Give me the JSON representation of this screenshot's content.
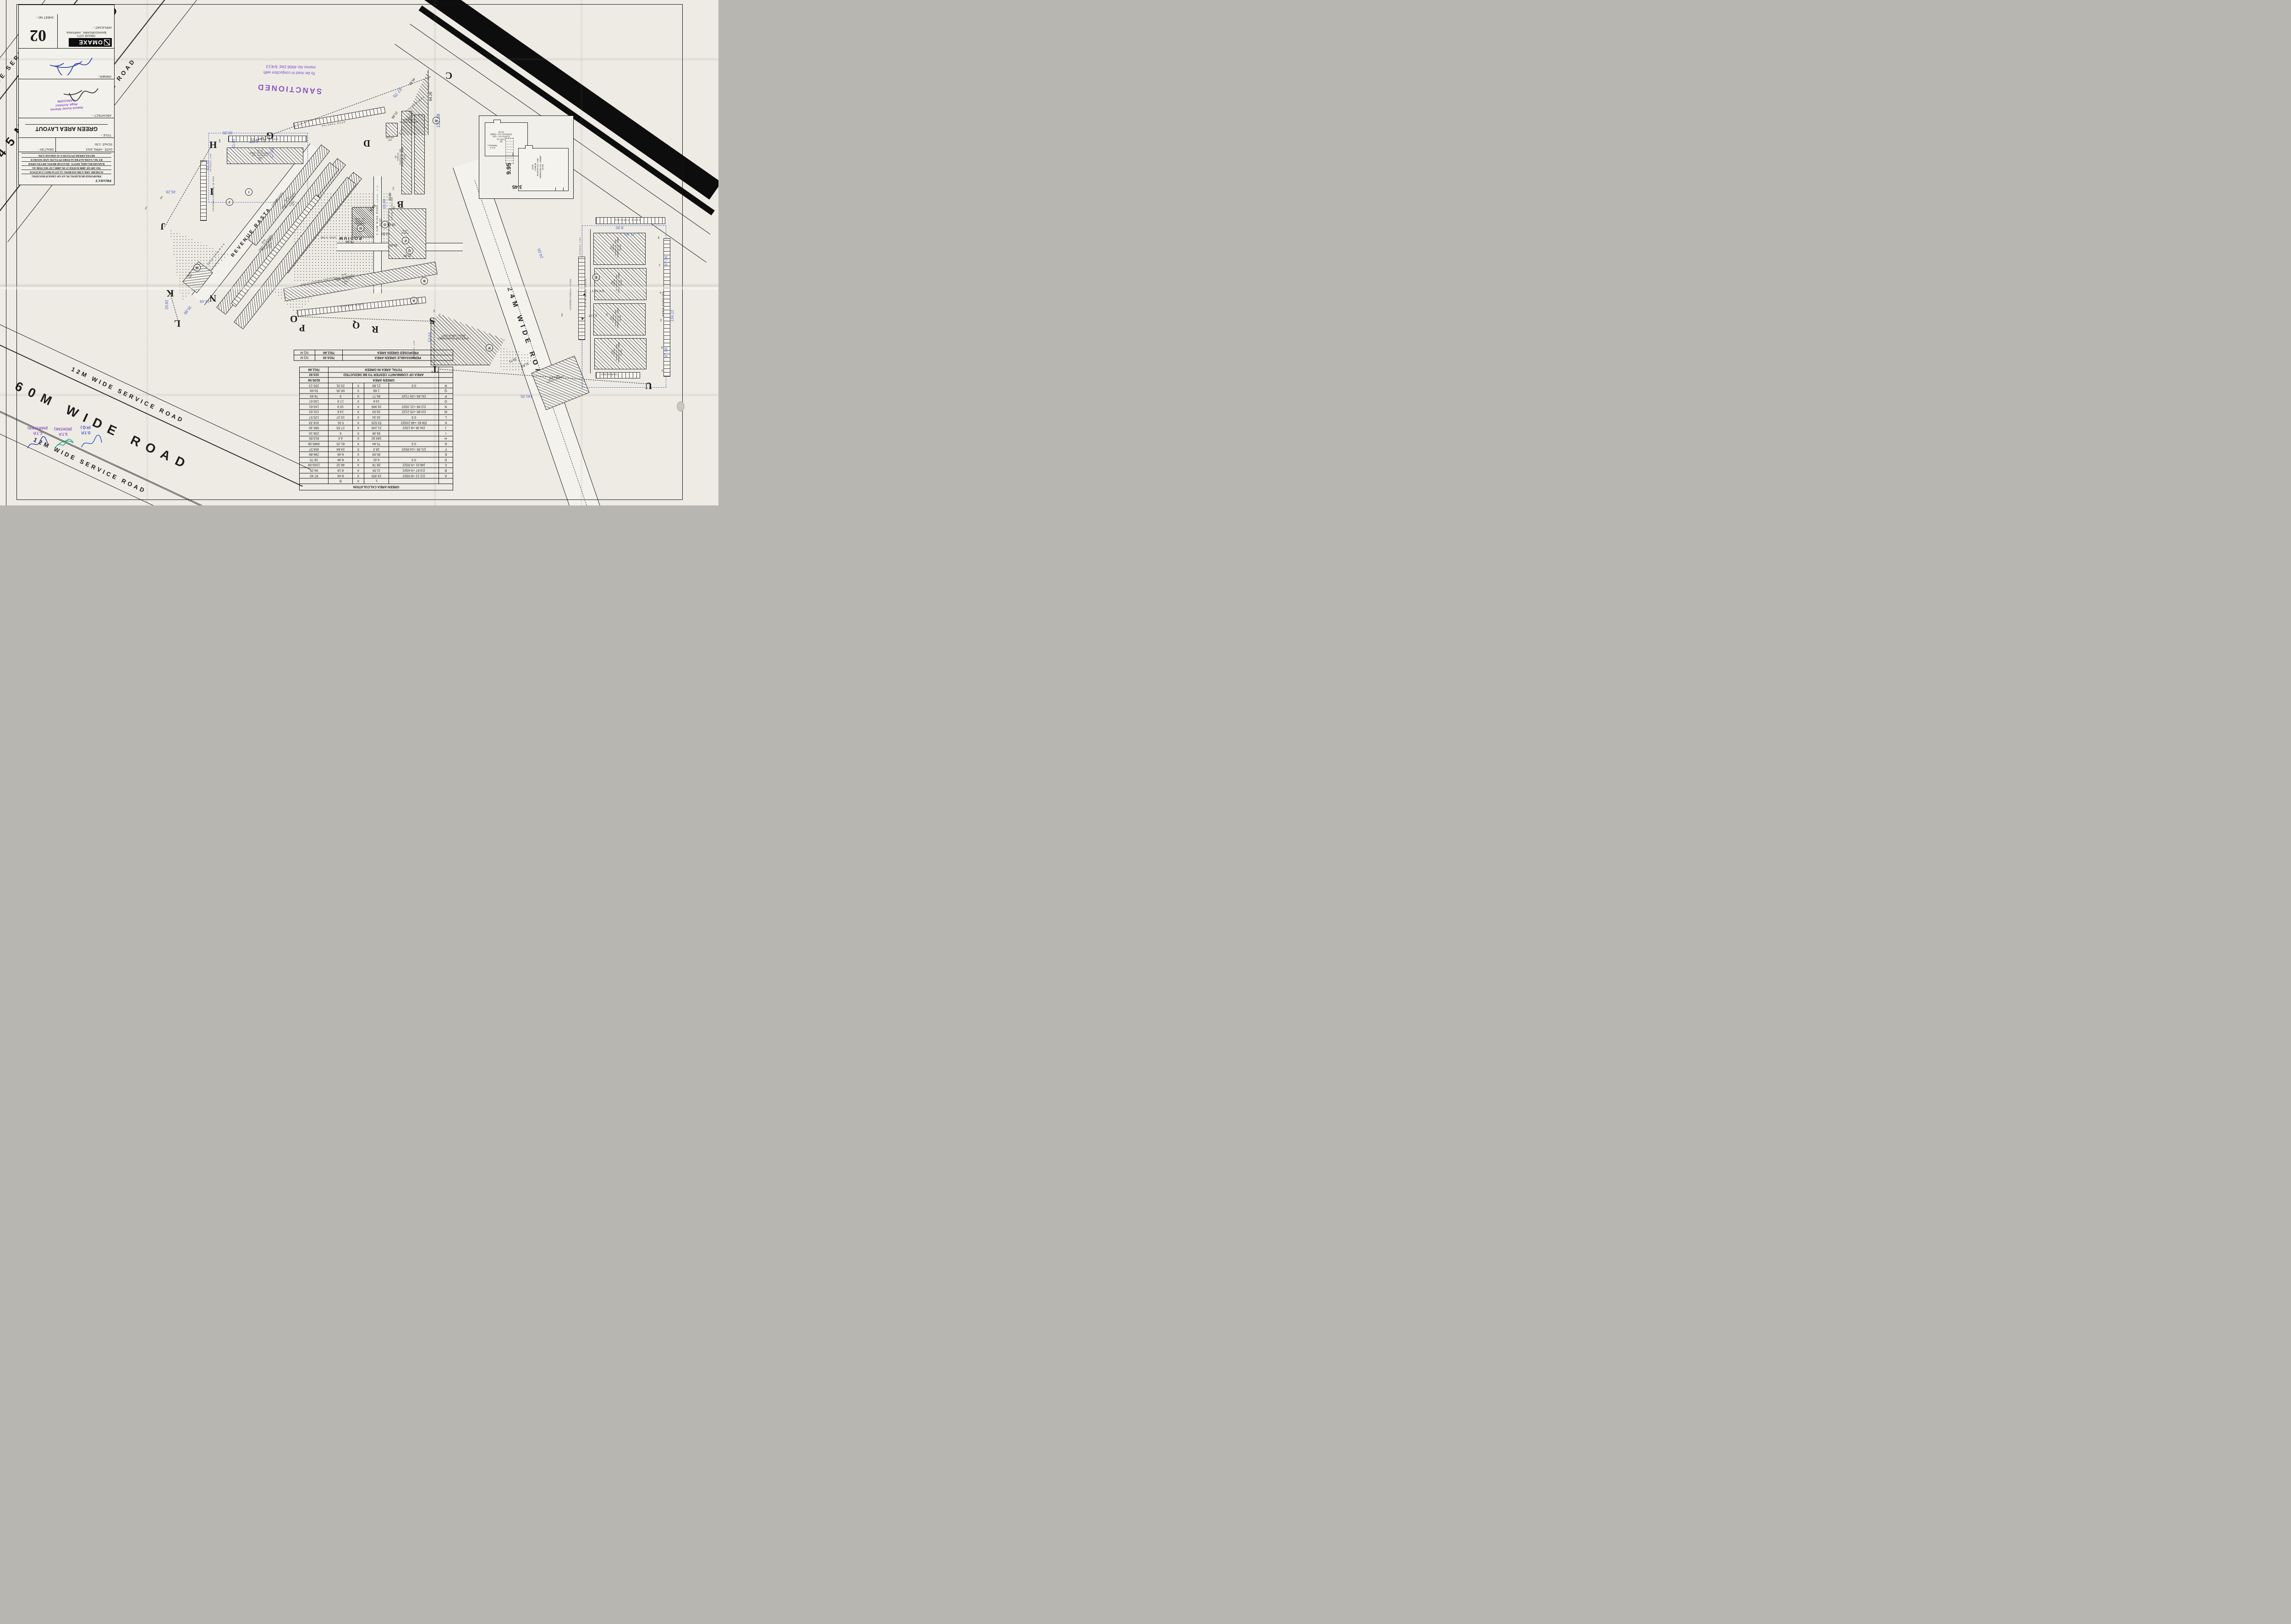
{
  "title_block": {
    "project_label": "PROJECT",
    "project_lines": [
      "PROPOSED BUILDING PLAN OF GROUP HOUSING",
      "SCHEME AREA MEASURING 12.537ACRES ( LICENCE",
      "NO-109 OF 2008 DATED 27-05-2008 ) AT SECTOR-4A",
      "BAHADURGARH, DISTT- JHAJJAR BEING DEVELOPED",
      "BY M/s SANKALP REALTORS PVT.LTD AND SOURCE",
      "DEVELOPERS PVT.LTD C/O OMAXE LTD."
    ],
    "date_label": "DATE",
    "date_value": "-  APRIL 2013",
    "dealt_label": "DEALT BY -",
    "scale_label": "SCALE",
    "scale_value": "-1:50",
    "title_label": "TITLE :-",
    "title_value": "GREEN AREA LAYOUT",
    "architect_label": "ARCHITECT :-",
    "architect_stamp_l1": "Rakesh Kumar Sharma",
    "architect_stamp_l2": "Regd. Architect",
    "architect_stamp_l3": "CA/91/13596",
    "owner_label": "OWNER:-",
    "applicant_label": "APPLICANT  :-",
    "brand": "OMAXE",
    "brand_sub1": "OMAXE CITY,",
    "brand_sub2": "BAHADURGARH , HARYANA.",
    "sheet_label": "SHEET NO :-",
    "sheet_number": "02"
  },
  "stamps": {
    "sanctioned": "SANCTIONED",
    "memo_l1": "To be read in conjuction with",
    "memo_l2": "memo No 4906  Dtd: 6/4/13",
    "dtp_l1": "D.T.P.",
    "dtp_l2": "(H.Q.)",
    "stp_l1": "S.T.P.",
    "stp_l2": "(ROHTAK)",
    "ctp_l1": "C.T.P.",
    "ctp_l2": "(HARYANA)"
  },
  "roads": {
    "r12_top": "12M WIDE SERVICE ROAD",
    "r45": "45M WIDE ROAD",
    "r12_mid": "12M WIDE SERVICE ROAD",
    "r12_low": "12M WIDE SERVICE ROAD",
    "r60": "60M WIDE ROAD",
    "r12_bottom": "12M WIDE SERVICE ROAD",
    "r24": "24M WIDE ROAD",
    "r24_level": "(-900MM LEVEL)",
    "revenue": "REVENUE RASTA",
    "revenue_level": "(-1500MM LEVEL)",
    "r6_v": "6.00M WIDE ROAD",
    "r6_v_level": "(LEVEL -0.0)",
    "r6_h": "6.00M WIDE ROAD",
    "r6_wing": "6.00M WIDE ROAD",
    "r6_cluster": "6.0 M WIDE ROAD",
    "r8": "8.0 M WIDE ROAD",
    "pathway": "6.0 M WIDE PATHWAY"
  },
  "plan": {
    "letters": {
      "b": "B",
      "c": "C",
      "d": "D",
      "g": "G",
      "h": "H",
      "i": "I",
      "j": "J",
      "k": "K",
      "l": "L",
      "n": "N",
      "o": "O",
      "p": "P",
      "q": "Q",
      "r": "R",
      "s": "S",
      "t": "T",
      "u": "U"
    },
    "markers": {
      "a": "A",
      "b": "B",
      "e": "E",
      "f": "F",
      "g": "G",
      "i": "I",
      "j": "J",
      "m": "M",
      "o": "O",
      "p": "P",
      "q": "Q",
      "r": "R"
    },
    "labels": {
      "community": [
        "COMMUNITY",
        "CENTER",
        "LVL +9.050"
      ],
      "podium": "PODIUM",
      "podium_lvl": "(LEVEL +5.75M)",
      "nursery1": [
        "NURSERY SCHOOL",
        "1050.00 SQM"
      ],
      "nursery2": [
        "NURSERY SCHOOL",
        "890.00 SQM"
      ],
      "transformer": [
        "SPACE FOR TRANSFORMER",
        "AREA = 1840.00 SQ.FT"
      ],
      "stp": [
        "STP",
        "136 SQM"
      ],
      "ews": [
        "EWS",
        "(S+8)"
      ],
      "type_a": [
        "(1)",
        "TYPE-A",
        "PLINTH LVL +150",
        "TERRACE LVL +33800",
        "(S+10)"
      ],
      "type_a1": [
        "(2)",
        "TYPE-A1",
        "PLINTH LVL +150",
        "TERRACE LVL +29900",
        "(S+8)"
      ],
      "type_a2": [
        "(5)",
        "TYPE-A2",
        "PLINTH LVL +150",
        "TERRACE LVL +30850",
        "(S+9)"
      ],
      "type_b3": [
        "(3)",
        "TYPE-B",
        "PLINTH LVL +150",
        "TERRACE LVL +30850",
        "(S+9)"
      ],
      "type_b4": [
        "(4)",
        "TYPE-B",
        "PLINTH LVL +150",
        "TERRACE LVL +30850",
        "(S+9)"
      ],
      "type_b_e": [
        "TYPE-B",
        "(S+9)"
      ],
      "type_b1_21": [
        "(21)",
        "TYPE-B1",
        "PLINTH LVL +150",
        "TERRACE LVL +33800",
        "(S+10)"
      ],
      "type_b1_20": [
        "(20)",
        "TYPE-B1",
        "PLINTH LVL +150",
        "TERRACE LVL +33800",
        "(S+10)"
      ],
      "type_b1_19": [
        "(19)",
        "TYPE-B1",
        "PLINTH LVL +150",
        "TERRACE LVL +33800",
        "(S+10)"
      ],
      "type_b1_18": [
        "(18)",
        "TYPE-B1",
        "PLINTH LVL +150",
        "TERRACE LVL +33800",
        "(S+10)"
      ]
    },
    "inset": {
      "a2": [
        "(5)",
        "TYPE-A2",
        "PLINTH LVL +150",
        "TERRACE LVL +30850",
        "(S+9)"
      ],
      "b": [
        "(12a)",
        "TYPE-B",
        "PLINTH LVL +150",
        "TERRACE LVL +30850",
        "(S+9)"
      ],
      "pergola": [
        "R.C.C",
        "PERGOLA"
      ],
      "d1": "9.95",
      "d2": "3.45"
    },
    "parking": {
      "open": "OPEN PARKING",
      "covered17": "COVERED PARKING-17NOS",
      "covered12": "COVERED PARKING-12 NOS",
      "covered10": "COVERED PARKING-10 NOS",
      "cpark6": "C.PARKING-6NOS",
      "entry": "ENTRY",
      "exit": "EXIT",
      "setback": "SETBACK LINE"
    },
    "dims": {
      "d1": "64.26",
      "d2": "122.38",
      "d3": "87.75",
      "d4": "46.85",
      "d5": "60.35",
      "d6": "63.70",
      "d7": "57.00",
      "d8": "45.26",
      "d9": "8.00",
      "d10": "11.00",
      "d11": "13.42",
      "d12": "134.12",
      "d13": "67.06",
      "d14": "67.06",
      "d15": "181.05",
      "d16": "53.64",
      "d17": "24.00",
      "d18": "35.88",
      "d19": "26.82",
      "d20": "12.48",
      "d21": "33.90",
      "d22": "81.25",
      "d23": "75.94",
      "d24": "35.09",
      "d25": "14.60",
      "d26": "18.20",
      "d27": "25.81",
      "d28": "21.57",
      "d29": "21.89",
      "d30": "23.31",
      "d31": "29.71",
      "d32": "31.83",
      "d35": "10.00",
      "d36": "8.00",
      "d37": "11.00"
    },
    "plots": {
      "p37": "37",
      "p38": "38",
      "p54": "54",
      "p61": "61",
      "p72": "72",
      "p85": "85",
      "p95": "95",
      "p110": "110",
      "p111": "111",
      "p197": "197",
      "p198": "198",
      "p228": "228",
      "p249": "249",
      "p257": "257",
      "p272": "272",
      "p281": "281"
    }
  },
  "calc_table": {
    "title": "GREEN AREA CALCULATION",
    "header": {
      "l": "L",
      "x": "X",
      "b": "B"
    },
    "rows": [
      {
        "id": "A",
        "f": "(12.12 +8.59)/2",
        "l": "10.355",
        "x": "X",
        "b": "8.44",
        "a": "87.40"
      },
      {
        "id": "B",
        "f": "(13.67 +9.43)/2",
        "l": "11.55",
        "x": "X",
        "b": "8.16",
        "a": "94.25"
      },
      {
        "id": "C",
        "f": "(48.01 +9.55)/2",
        "l": "28.78",
        "x": "X",
        "b": "46.32",
        "a": "1333.09"
      },
      {
        "id": "D",
        "f": "0.5",
        "l": "4.42",
        "x": "X",
        "b": "8.46",
        "a": "18.70"
      },
      {
        "id": "E",
        "f": "",
        "l": "35.09",
        "x": "X",
        "b": "8.46",
        "a": "296.86"
      },
      {
        "id": "F",
        "f": "(21.95 +14.65)/2",
        "l": "18.3",
        "x": "X",
        "b": "24.84",
        "a": "454.57"
      },
      {
        "id": "G",
        "f": "0.5",
        "l": "75.94",
        "x": "X",
        "b": "81.25",
        "a": "3085.06"
      },
      {
        "id": "H",
        "f": "",
        "l": "184.92",
        "x": "X",
        "b": "4.4",
        "a": "813.65"
      },
      {
        "id": "I",
        "f": "",
        "l": "39.36",
        "x": "X",
        "b": "6",
        "a": "236.16"
      },
      {
        "id": "J",
        "f": "(34.36 +8.13)/2",
        "l": "21.245",
        "x": "X",
        "b": "27.55",
        "a": "585.30"
      },
      {
        "id": "K",
        "f": "(58.82 +48.233)/2",
        "l": "53.525",
        "x": "X",
        "b": "5.91",
        "a": "316.33"
      },
      {
        "id": "L",
        "f": "0.5",
        "l": "16.34",
        "x": "X",
        "b": "15.37",
        "a": "125.57"
      },
      {
        "id": "M",
        "f": "(10.85 +25.21)/2",
        "l": "18.03",
        "x": "X",
        "b": "14.6",
        "a": "131.62"
      },
      {
        "id": "N",
        "f": "(12.66 +21.33)/2",
        "l": "16.995",
        "x": "X",
        "b": "16.9",
        "a": "143.61"
      },
      {
        "id": "O",
        "f": "",
        "l": "14.6",
        "x": "X",
        "b": "17.9",
        "a": "130.67"
      },
      {
        "id": "P",
        "f": "(31.83 +29.71)/2",
        "l": "30.77",
        "x": "X",
        "b": "5",
        "a": "76.93"
      },
      {
        "id": "Q",
        "f": "",
        "l": "1.68",
        "x": "X",
        "b": "60.35",
        "a": "50.69"
      },
      {
        "id": "R",
        "f": "0.5",
        "l": "21.89",
        "x": "X",
        "b": "23.31",
        "a": "255.13"
      }
    ],
    "summary": [
      {
        "label": "GREEN AREA",
        "value": "8235.58"
      },
      {
        "label": "AREA OF COMMUNITY CENTER TO BE DEDUCTED",
        "value": "323.92"
      },
      {
        "label": "TOTAL AREA IN GREEN",
        "value": "7911.66"
      }
    ]
  },
  "summary_table": {
    "rows": [
      {
        "label": "PERMISSABLE GREEN AREA",
        "value": "7610.30",
        "unit": "SQ.M"
      },
      {
        "label": "PROPOSED GREEN AREA",
        "value": "7911.66",
        "unit": "SQ.M"
      }
    ]
  }
}
